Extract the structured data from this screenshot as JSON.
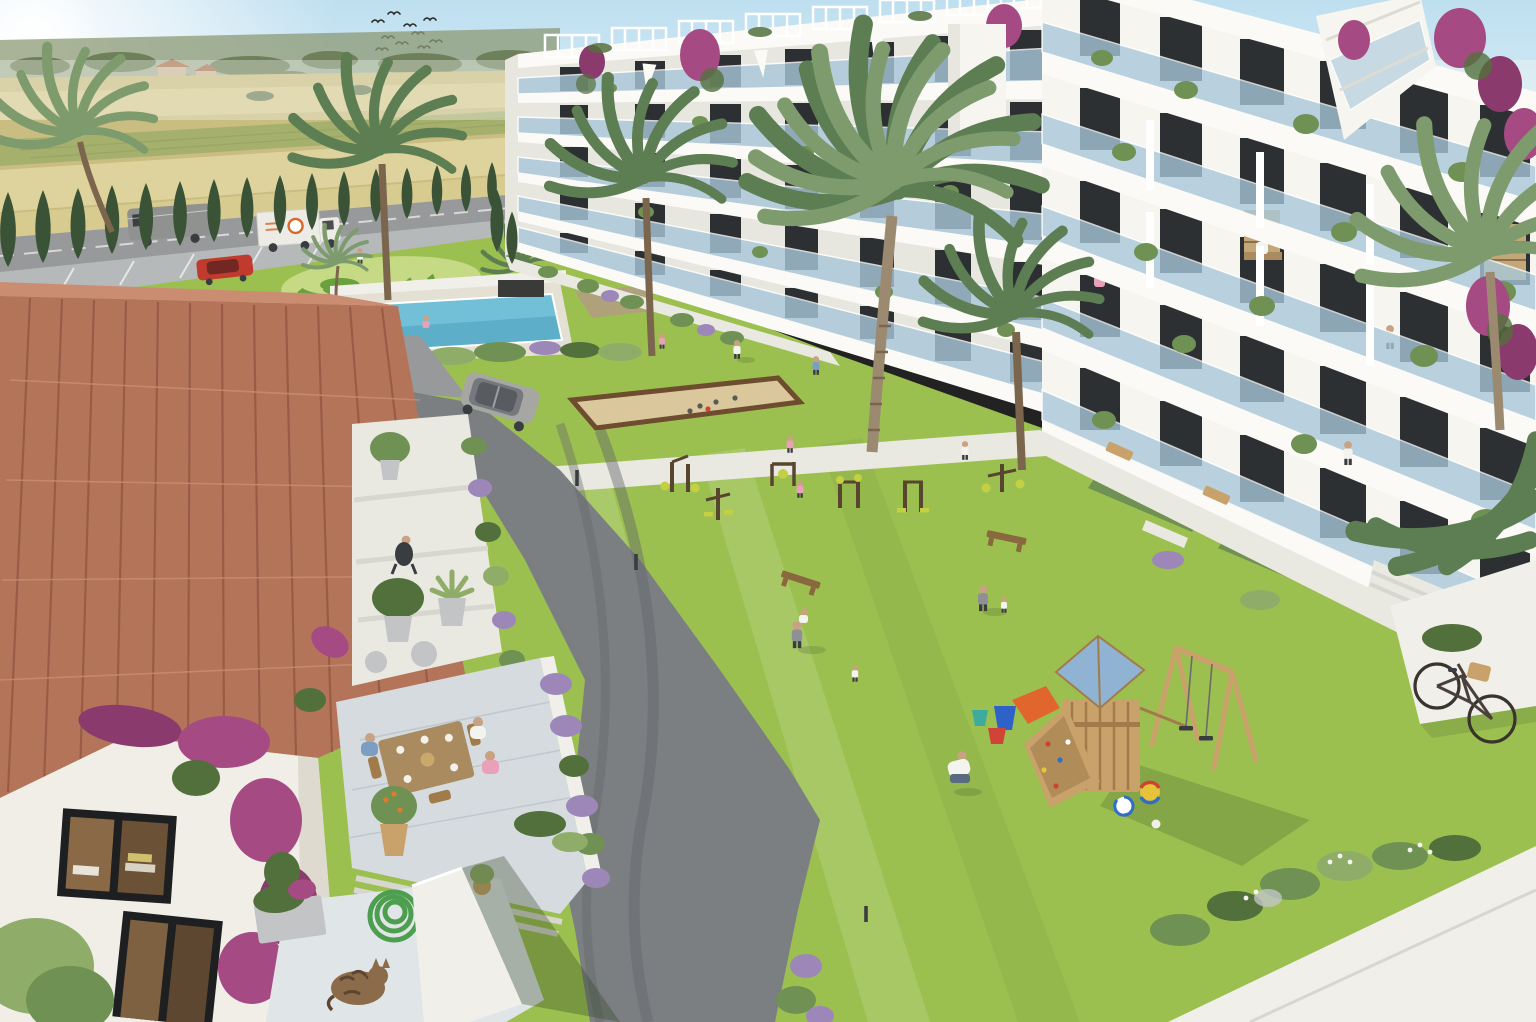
{
  "scene": {
    "type": "aerial-architectural-rendering",
    "setting": "mediterranean-apartment-complex-courtyard",
    "sky": {
      "sun_position": "top-left",
      "bird_count": 12
    },
    "background": {
      "terrain": "wheat-fields-with-green-crop-strip",
      "distant_houses": 2,
      "highway_vehicles": [
        "gray-van",
        "white-box-truck"
      ],
      "parked_vehicles": [
        "red-car"
      ],
      "cypress_tree_count": 16
    },
    "buildings": {
      "mid_building": {
        "floors": 5,
        "style": "white-modern-glass-balconies",
        "roof_pergolas": 8,
        "rooftop_umbrellas": 3
      },
      "right_building": {
        "floors": 5,
        "style": "white-modern-glass-balconies",
        "balcony_people": 3,
        "exterior_stair_tower": 1
      },
      "facade_flowers": "bougainvillea"
    },
    "amenities": {
      "swimming_pool": {
        "swimmers": 2
      },
      "decorative_swirl_lawn": 1,
      "petanque_court": {
        "boules": 5
      },
      "exercise_machines": 6,
      "benches": 2,
      "light_bollards": 3,
      "playground": {
        "roof_color": "blue",
        "slide_color": "orange",
        "swings": 2,
        "balls": 3,
        "buckets": 3,
        "climbing_wall": 1
      }
    },
    "people": {
      "lawn_walkers": 4,
      "children_playing": 5,
      "parent_with_baby": 1,
      "parent_with_toddler": 1,
      "path_walkers": 2,
      "terrace_diners": 3,
      "seated_resident": 1
    },
    "foreground": {
      "house_roof": "terracotta-tiles",
      "terrace": [
        "dining-table",
        "potted-orange-tree",
        "lavender-border",
        "stone-pots"
      ],
      "details": [
        "green-garden-hose",
        "sleeping-tabby-cat",
        "bicycle-with-basket",
        "suv-on-driveway"
      ]
    }
  },
  "colors": {
    "sky1": "#bedff0",
    "sky2": "#edf6f9",
    "sun": "#ffffff",
    "haze": "#f6f9f4",
    "hill": "#8c9a74",
    "treefar": "#6e8059",
    "farhouse": "#cbb79a",
    "farroof": "#a9714f",
    "field1": "#d8cb90",
    "field2": "#c9bd82",
    "field3": "#e0d5a0",
    "fieldg": "#9fae6a",
    "road": "#97999b",
    "roadD": "#7b7f81",
    "park": "#b6b9ba",
    "cyp": "#3a5236",
    "lawn": "#9cc050",
    "lawnL": "#abce62",
    "lawnD": "#86b244",
    "swirl": "#6ba13c",
    "swirlL": "#c6da85",
    "pool": "#72c0d8",
    "poolD": "#4d9fbe",
    "deck": "#e4e1d4",
    "bldg": "#f6f5f0",
    "bldgSh": "#e7e6df",
    "slab": "#fbfaf7",
    "slabSh": "#c9c9c0",
    "glass": "#a9c8da",
    "win": "#2d3033",
    "perg": "#ffffff",
    "boug": "#a64a84",
    "bougD": "#8a3a6c",
    "lav": "#9d87b9",
    "shrub": "#6f9153",
    "shrubD": "#52703c",
    "shrubL": "#8fad69",
    "sand": "#dbc79c",
    "woodF": "#6d4c2f",
    "wood": "#c8a26a",
    "woodD": "#a17c4a",
    "playRoof": "#90b3d3",
    "slide": "#e0662e",
    "ballB": "#2e6ec6",
    "ballY": "#e6c33a",
    "ballR": "#cd4334",
    "bktB": "#2e62c8",
    "bktR": "#d04337",
    "bktT": "#3dac9c",
    "tile": "#b4745a",
    "tileD": "#8f5540",
    "tileL": "#cb8d72",
    "stucco": "#f0eee7",
    "stuccoSh": "#dedacf",
    "terr": "#d5dbdf",
    "terrD": "#bac3ca",
    "terrLt": "#e0e5e8",
    "tbl": "#aa8b60",
    "skin": "#c9a183",
    "white": "#f3f3ef",
    "pink": "#e9a0b9",
    "gray": "#8e9095",
    "blue": "#7c9ec2",
    "dark": "#3a3d40",
    "hose": "#4d9e4e",
    "cat": "#8b6b49",
    "catD": "#5e4530",
    "suv": "#a6a6a2",
    "truck": "#edebe5",
    "logo": "#d8682a",
    "van": "#909290",
    "car": "#c03a2d",
    "bench": "#8a683f",
    "pole": "#57452f",
    "accent": "#c3d044",
    "path": "#e9e8e1",
    "pathD": "#d7d6cf",
    "slabW": "#f0efe9",
    "trunk": "#9b8a70",
    "trunkD": "#7b664d",
    "palm": "#7e9b6d",
    "palmD": "#5d7d52",
    "stone": "#c2c4c6",
    "shadow": "#2e4020",
    "paver": "#b49a86",
    "book": "#c2a878"
  }
}
